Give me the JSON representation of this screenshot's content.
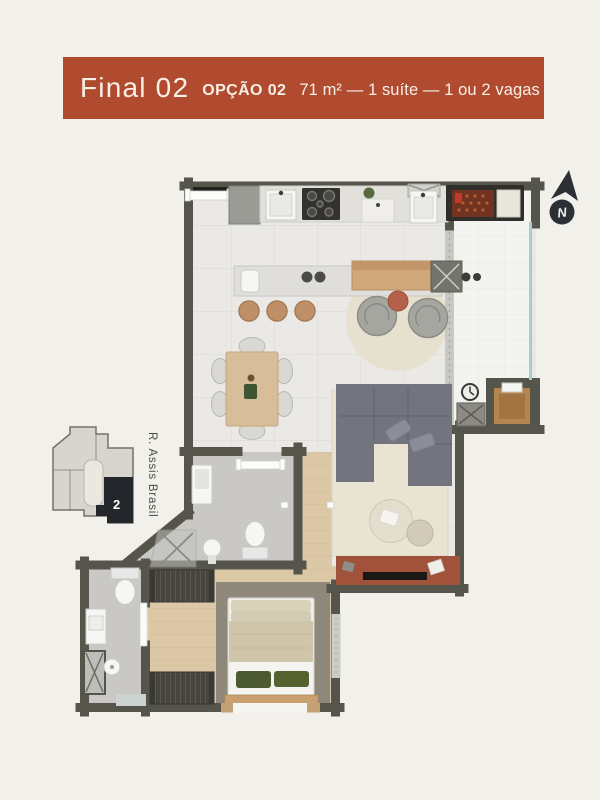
{
  "header": {
    "final_label": "Final 02",
    "option_label": "OPÇÃO 02",
    "specs": "71 m² — 1 suíte — 1 ou 2 vagas"
  },
  "compass": {
    "label": "N"
  },
  "keyplan": {
    "unit_label": "2",
    "street_label": "R. Assis Brasil"
  },
  "theme": {
    "bg": "#f2f0ea",
    "banner": "#b14b2f",
    "bannerText": "#f8efe6",
    "wall": "#56554c",
    "tile": "#eae9e5",
    "tileLine": "#dddcd6",
    "balcony": "#f3f3f0",
    "balconyLine": "#e8e8e4",
    "glass": "#a9cdd0",
    "curtain": "#c8c8c2",
    "wood": "#dcc8a6",
    "woodLine": "#cdb691",
    "bath": "#c9c8c4",
    "rug": "#e9e3d2",
    "rugRound": "#e6e0cf",
    "rugBed": "#8e887b",
    "sofa": "#73757e",
    "sofaLine": "#626470",
    "pillow": "#8b8d97",
    "terracotta": "#a0523a",
    "tTable": "#b4604a",
    "bench": "#d0a67b",
    "stool": "#bf9068",
    "counter": "#e1e0db",
    "island": "#dfdeda",
    "dark": "#22211e",
    "gray": "#9b9b96",
    "wardrobe": "#46453e",
    "duvet": "#cec5ab",
    "sheet": "#f4f3ef",
    "pillowGreen": "#4d5a31",
    "coal": "#70331f",
    "fixture": "#f6f6f4",
    "fixStroke": "#cbcbc6",
    "keyLight": "#d8d5ce",
    "keyStroke": "#73726a",
    "keyDark": "#23262b",
    "keyCore": "#ebe8df",
    "ink": "#2c2f34",
    "street": "#4b4b46"
  }
}
